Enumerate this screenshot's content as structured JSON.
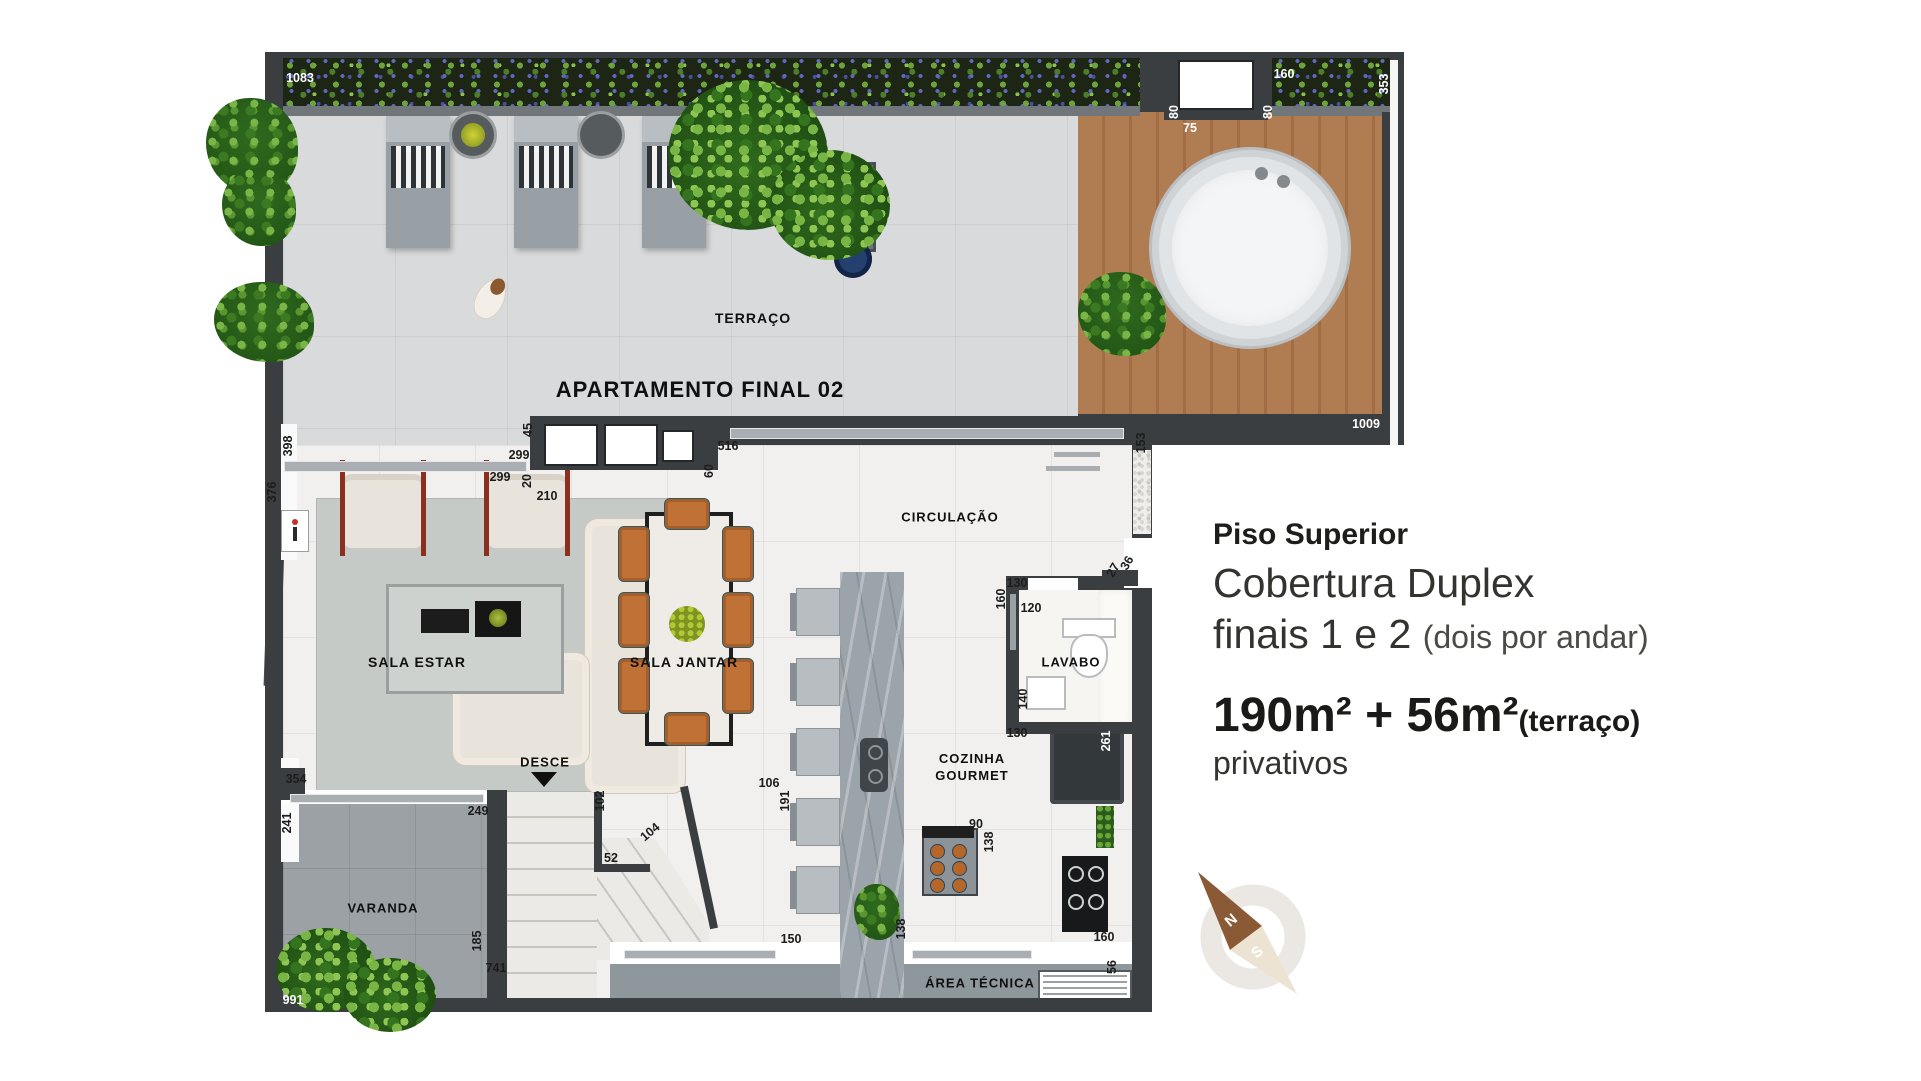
{
  "plan": {
    "rooms": [
      {
        "id": "terraco",
        "label": "TERRAÇO"
      },
      {
        "id": "apartamento",
        "label": "APARTAMENTO FINAL 02"
      },
      {
        "id": "circulacao",
        "label": "CIRCULAÇÃO"
      },
      {
        "id": "sala-estar",
        "label": "SALA ESTAR"
      },
      {
        "id": "sala-jantar",
        "label": "SALA JANTAR"
      },
      {
        "id": "lavabo",
        "label": "LAVABO"
      },
      {
        "id": "cozinha-gourmet",
        "label": "COZINHA GOURMET"
      },
      {
        "id": "desce",
        "label": "DESCE"
      },
      {
        "id": "varanda",
        "label": "VARANDA"
      },
      {
        "id": "area-tecnica",
        "label": "ÁREA TÉCNICA"
      }
    ],
    "dimensions": [
      {
        "id": "top-1083",
        "text": "1083"
      },
      {
        "id": "win-80-left",
        "text": "80"
      },
      {
        "id": "win-75",
        "text": "75"
      },
      {
        "id": "win-80-right",
        "text": "80"
      },
      {
        "id": "win-160",
        "text": "160"
      },
      {
        "id": "right-353",
        "text": "353"
      },
      {
        "id": "deck-1009",
        "text": "1009"
      },
      {
        "id": "left-398",
        "text": "398"
      },
      {
        "id": "left-376",
        "text": "376"
      },
      {
        "id": "mid-45",
        "text": "45"
      },
      {
        "id": "mid-299-a",
        "text": "299"
      },
      {
        "id": "mid-299-b",
        "text": "299"
      },
      {
        "id": "mid-20",
        "text": "20"
      },
      {
        "id": "mid-210",
        "text": "210"
      },
      {
        "id": "mid-516",
        "text": "516"
      },
      {
        "id": "mid-60",
        "text": "60"
      },
      {
        "id": "right-153",
        "text": "153"
      },
      {
        "id": "right-27",
        "text": "27"
      },
      {
        "id": "right-36",
        "text": "36"
      },
      {
        "id": "lav-130-top",
        "text": "130"
      },
      {
        "id": "lav-160",
        "text": "160"
      },
      {
        "id": "lav-120",
        "text": "120"
      },
      {
        "id": "lav-140",
        "text": "140"
      },
      {
        "id": "lav-130-bottom",
        "text": "130"
      },
      {
        "id": "right-261",
        "text": "261"
      },
      {
        "id": "stair-102",
        "text": "102"
      },
      {
        "id": "stair-104",
        "text": "104"
      },
      {
        "id": "stair-52",
        "text": "52"
      },
      {
        "id": "kitchen-106",
        "text": "106"
      },
      {
        "id": "kitchen-191",
        "text": "191"
      },
      {
        "id": "left-354",
        "text": "354"
      },
      {
        "id": "left-241",
        "text": "241"
      },
      {
        "id": "varanda-249",
        "text": "249"
      },
      {
        "id": "varanda-185",
        "text": "185"
      },
      {
        "id": "varanda-741",
        "text": "741"
      },
      {
        "id": "left-991",
        "text": "991"
      },
      {
        "id": "bottom-150",
        "text": "150"
      },
      {
        "id": "bottom-138-a",
        "text": "138"
      },
      {
        "id": "table-90",
        "text": "90"
      },
      {
        "id": "table-138",
        "text": "138"
      },
      {
        "id": "bottom-160",
        "text": "160"
      },
      {
        "id": "bottom-56",
        "text": "56"
      }
    ]
  },
  "info_panel": {
    "title": "Piso Superior",
    "line2": "Cobertura Duplex",
    "line3": "finais 1 e 2",
    "line3_note": "(dois por andar)",
    "area_value": "190m² + 56m²",
    "area_note": "(terraço)",
    "area_caption": "privativos"
  },
  "compass": {
    "north_label": "N",
    "south_label": "S"
  },
  "colors": {
    "wall": "#3b3e40",
    "terrace_floor": "#d9dadb",
    "interior_floor": "#f1f0ee",
    "deck_wood": "#ab7750",
    "dining_chair_orange": "#bf7136",
    "compass_north": "#8a5a36",
    "compass_south": "#ece3d2",
    "text": "#1c1c1c"
  }
}
